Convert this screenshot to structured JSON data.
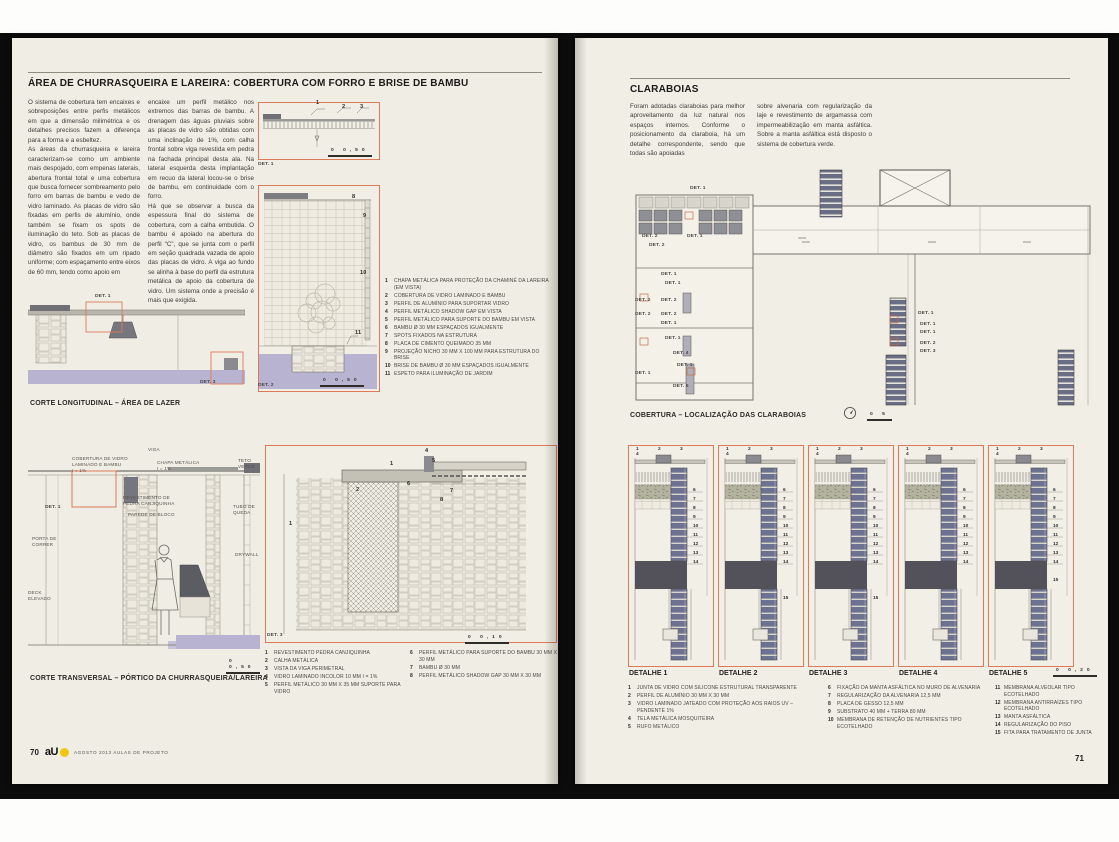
{
  "colors": {
    "accent_orange": "#dd7a58",
    "lavender": "#b7b3d1",
    "block_navy": "#6d7290",
    "slab_gray": "#53525b",
    "logo_yellow": "#f2c50f",
    "page_cream": "#f0ede4"
  },
  "left_page": {
    "title": "ÁREA DE CHURRASQUEIRA E LAREIRA: COBERTURA COM FORRO E BRISE DE BAMBU",
    "intro_col1": "O sistema de cobertura tem encaixes e sobreposições entre perfis metálicos em que a dimensão milimétrica e os detalhes precisos fazem a diferença para a forma e a esbeltez.\nAs áreas da churrasqueira e lareira caracterizam-se como um ambiente mais despojado, com empenas laterais, abertura frontal total e uma cobertura que busca fornecer sombreamento pelo forro em barras de bambu e vedo de vidro laminado. As placas de vidro são fixadas em perfis de alumínio, onde também se fixam os spots de iluminação do teto. Sob as placas de vidro, os bambus de 30 mm de diâmetro são fixados em um ripado uniforme; com espaçamento entre eixos de 60 mm, tendo como apoio em",
    "intro_col2": "encaixe um perfil metálico nos extremos das barras de bambu. A drenagem das águas pluviais sobre as placas de vidro são obtidas com uma inclinação de 1%, com calha frontal sobre viga revestida em pedra na fachada principal desta ala. Na lateral esquerda desta implantação em recuo da lateral locou-se o brise de bambu, em continuidade com o forro.\nHá que se observar a busca da espessura final do sistema de cobertura, com a calha embutida. O bambu é apoiado na abertura do perfil “C”, que se junta com o perfil em seção quadrada vazada de apoio das placas de vidro. A viga ao fundo se alinha à base do perfil da estrutura metálica de apoio da cobertura de vidro. Um sistema onde a precisão é mais que exigida.",
    "caption_longitudinal": "CORTE LONGITUDINAL – ÁREA DE LAZER",
    "caption_transversal": "CORTE TRANSVERSAL – PÓRTICO DA CHURRASQUEIRA/LAREIRA",
    "legend_top": [
      {
        "n": "1",
        "text": "CHAPA METÁLICA PARA PROTEÇÃO DA CHAMINÉ DA LAREIRA (EM VISTA)"
      },
      {
        "n": "2",
        "text": "COBERTURA DE VIDRO LAMINADO E BAMBU"
      },
      {
        "n": "3",
        "text": "PERFIL DE ALUMÍNIO PARA SUPORTAR VIDRO"
      },
      {
        "n": "4",
        "text": "PERFIL METÁLICO SHADOW GAP EM VISTA"
      },
      {
        "n": "5",
        "text": "PERFIL METÁLICO PARA SUPORTE DO BAMBU EM VISTA"
      },
      {
        "n": "6",
        "text": "BAMBU Ø 30 MM ESPAÇADOS IGUALMENTE"
      },
      {
        "n": "7",
        "text": "SPOTS FIXADOS NA ESTRUTURA"
      },
      {
        "n": "8",
        "text": "PLACA DE CIMENTO QUEIMADO 35 MM"
      },
      {
        "n": "9",
        "text": "PROJEÇÃO NICHO 30 MM X 100 MM PARA ESTRUTURA DO BRISE"
      },
      {
        "n": "10",
        "text": "BRISE DE BAMBU Ø 30 MM ESPAÇADOS IGUALMENTE"
      },
      {
        "n": "11",
        "text": "ESPETO PARA ILUMINAÇÃO DE JARDIM"
      }
    ],
    "legend_bottom_a": [
      {
        "n": "1",
        "text": "REVESTIMENTO PEDRA CANJIQUINHA"
      },
      {
        "n": "2",
        "text": "CALHA METÁLICA"
      },
      {
        "n": "3",
        "text": "VISTA DA VIGA PERIMETRAL"
      },
      {
        "n": "4",
        "text": "VIDRO LAMINADO INCOLOR 10 MM I = 1%"
      },
      {
        "n": "5",
        "text": "PERFIL METÁLICO 30 MM X 35 MM SUPORTE PARA VIDRO"
      }
    ],
    "legend_bottom_b": [
      {
        "n": "6",
        "text": "PERFIL METÁLICO PARA SUPORTE DO BAMBU 30 MM X 30 MM"
      },
      {
        "n": "7",
        "text": "BAMBU Ø 30 MM"
      },
      {
        "n": "8",
        "text": "PERFIL METÁLICO SHADOW GAP 30 MM X 30 MM"
      }
    ],
    "det1_anns": [
      {
        "text": "1",
        "x": 58,
        "y": -2,
        "cls": "callout"
      },
      {
        "text": "2",
        "x": 84,
        "y": 2,
        "cls": "callout"
      },
      {
        "text": "3",
        "x": 102,
        "y": 2,
        "cls": "callout"
      },
      {
        "text": "DET. 1",
        "x": 0,
        "y": 60,
        "cls": "det"
      },
      {
        "text": "0  0,50",
        "x": 70,
        "y": 46,
        "cls": "scale"
      }
    ],
    "det2_anns": [
      {
        "text": "8",
        "x": 94,
        "y": 9,
        "cls": "callout"
      },
      {
        "text": "9",
        "x": 105,
        "y": 28,
        "cls": "callout"
      },
      {
        "text": "10",
        "x": 102,
        "y": 85,
        "cls": "callout"
      },
      {
        "text": "11",
        "x": 97,
        "y": 145,
        "cls": "callout"
      },
      {
        "text": "DET. 2",
        "x": 0,
        "y": 198,
        "cls": "det"
      },
      {
        "text": "0  0,50",
        "x": 62,
        "y": 193,
        "cls": "scale"
      }
    ],
    "long_anns": [
      {
        "text": "DET. 1",
        "x": 67,
        "y": -6,
        "cls": "det"
      },
      {
        "text": "DET. 3",
        "x": 172,
        "y": 80,
        "cls": "det"
      }
    ],
    "trans_anns": [
      {
        "text": "VIGA",
        "x": 120,
        "y": 2
      },
      {
        "text": "COBERTURA DE VIDRO\nLAMINADO E BAMBU\nI = 1%",
        "x": 44,
        "y": 11
      },
      {
        "text": "CHAPA METÁLICA\nI = 1%",
        "x": 129,
        "y": 15
      },
      {
        "text": "TETO\nVERDE",
        "x": 210,
        "y": 13
      },
      {
        "text": "REVESTIMENTO DE\nPEDRA CANJIQUINHA",
        "x": 95,
        "y": 50
      },
      {
        "text": "PAREDE DE BLOCO",
        "x": 100,
        "y": 67
      },
      {
        "text": "TUBO DE\nQUEDA",
        "x": 205,
        "y": 59
      },
      {
        "text": "DRYWALL",
        "x": 207,
        "y": 107
      },
      {
        "text": "PORTA DE\nCORRER",
        "x": 4,
        "y": 91
      },
      {
        "text": "DECK\nELEVADO",
        "x": 0,
        "y": 145
      },
      {
        "text": "DET. 1",
        "x": 17,
        "y": 60,
        "cls": "det"
      },
      {
        "text": "0  0,50",
        "x": 198,
        "y": 214,
        "cls": "scale"
      }
    ],
    "det3_anns": [
      {
        "text": "1",
        "x": 125,
        "y": 16,
        "cls": "callout"
      },
      {
        "text": "2",
        "x": 91,
        "y": 42,
        "cls": "callout"
      },
      {
        "text": "4",
        "x": 160,
        "y": 3,
        "cls": "callout"
      },
      {
        "text": "5",
        "x": 167,
        "y": 13,
        "cls": "callout"
      },
      {
        "text": "6",
        "x": 142,
        "y": 36,
        "cls": "callout"
      },
      {
        "text": "7",
        "x": 185,
        "y": 43,
        "cls": "callout"
      },
      {
        "text": "8",
        "x": 175,
        "y": 52,
        "cls": "callout"
      },
      {
        "text": "1",
        "x": 24,
        "y": 76,
        "cls": "callout"
      },
      {
        "text": "DET. 3",
        "x": 2,
        "y": 188,
        "cls": "det"
      },
      {
        "text": "0  0,10",
        "x": 200,
        "y": 190,
        "cls": "scale"
      }
    ],
    "footer": {
      "page_number": "70",
      "brand": "aU",
      "text": "AGOSTO 2013 AULAS DE PROJETO"
    }
  },
  "right_page": {
    "title": "CLARABOIAS",
    "intro_col1": "Foram adotadas claraboias para melhor aproveitamento da luz natural nos espaços internos. Conforme o posicionamento da claraboia, há um detalhe correspondente, sendo que todas são apoiadas",
    "intro_col2": "sobre alvenaria com regularização da laje e revestimento de argamassa com impermeabilização em manta asfáltica. Sobre a manta asfáltica está disposto o sistema de cobertura verde.",
    "caption_plan": "COBERTURA – LOCALIZAÇÃO DAS CLARABOIAS",
    "plan_scale": "0       5",
    "plan_labels": [
      {
        "text": "DET. 1",
        "x": 62,
        "y": 18,
        "cls": "det"
      },
      {
        "text": "DET. 2",
        "x": 14,
        "y": 66,
        "cls": "det"
      },
      {
        "text": "DET. 1",
        "x": 59,
        "y": 66,
        "cls": "det"
      },
      {
        "text": "DET. 2",
        "x": 21,
        "y": 75,
        "cls": "det"
      },
      {
        "text": "DET. 1",
        "x": 33,
        "y": 104,
        "cls": "det"
      },
      {
        "text": "DET. 1",
        "x": 37,
        "y": 113,
        "cls": "det"
      },
      {
        "text": "DET. 2",
        "x": 7,
        "y": 130,
        "cls": "det"
      },
      {
        "text": "DET. 2",
        "x": 33,
        "y": 130,
        "cls": "det"
      },
      {
        "text": "DET. 2",
        "x": 7,
        "y": 144,
        "cls": "det"
      },
      {
        "text": "DET. 2",
        "x": 33,
        "y": 144,
        "cls": "det"
      },
      {
        "text": "DET. 1",
        "x": 33,
        "y": 153,
        "cls": "det"
      },
      {
        "text": "DET. 1",
        "x": 37,
        "y": 168,
        "cls": "det"
      },
      {
        "text": "DET. 4",
        "x": 45,
        "y": 183,
        "cls": "det"
      },
      {
        "text": "DET. 1",
        "x": 49,
        "y": 195,
        "cls": "det"
      },
      {
        "text": "DET. 1",
        "x": 7,
        "y": 203,
        "cls": "det"
      },
      {
        "text": "DET. 5",
        "x": 45,
        "y": 216,
        "cls": "det"
      },
      {
        "text": "DET. 1",
        "x": 290,
        "y": 143,
        "cls": "det"
      },
      {
        "text": "DET. 1",
        "x": 292,
        "y": 154,
        "cls": "det"
      },
      {
        "text": "DET. 1",
        "x": 292,
        "y": 162,
        "cls": "det"
      },
      {
        "text": "DET. 2",
        "x": 292,
        "y": 173,
        "cls": "det"
      },
      {
        "text": "DET. 3",
        "x": 292,
        "y": 181,
        "cls": "det"
      }
    ],
    "details": [
      {
        "label": "DETALHE 1",
        "cls": "short",
        "top": "1 2 3 4",
        "side": "6\n7\n8\n9\n10\n11\n12\n13\n14"
      },
      {
        "label": "DETALHE 2",
        "cls": "long",
        "top": "1 2 3 4",
        "side": "6\n7\n8\n9\n10\n11\n12\n13\n14\n\n\n\n15"
      },
      {
        "label": "DETALHE 3",
        "cls": "long",
        "top": "1 2 3 4",
        "side": "6\n7\n8\n9\n10\n11\n12\n13\n14\n\n\n\n15"
      },
      {
        "label": "DETALHE 4",
        "cls": "short",
        "top": "1 2 3 4",
        "side": "6\n7\n8\n9\n10\n11\n12\n13\n14"
      },
      {
        "label": "DETALHE 5",
        "cls": "long",
        "top": "1 2 3 4",
        "side": "6\n7\n8\n9\n10\n11\n12\n13\n14\n\n15"
      }
    ],
    "detail_scale": "0  0,20",
    "legend_col1": [
      {
        "n": "1",
        "text": "JUNTA DE VIDRO COM SILICONE ESTRUTURAL TRANSPARENTE"
      },
      {
        "n": "2",
        "text": "PERFIL DE ALUMÍNIO 30 MM X 30 MM"
      },
      {
        "n": "3",
        "text": "VIDRO LAMINADO JATEADO COM PROTEÇÃO AOS RAIOS UV – PENDENTE 1%"
      },
      {
        "n": "4",
        "text": "TELA METÁLICA MOSQUITEIRA"
      },
      {
        "n": "5",
        "text": "RUFO METÁLICO"
      }
    ],
    "legend_col2": [
      {
        "n": "6",
        "text": "FIXAÇÃO DA MANTA ASFÁLTICA NO MURO DE ALVENARIA"
      },
      {
        "n": "7",
        "text": "REGULARIZAÇÃO DA ALVENARIA 12,5 MM"
      },
      {
        "n": "8",
        "text": "PLACA DE GESSO 12,5 MM"
      },
      {
        "n": "9",
        "text": "SUBSTRATO 40 MM + TERRA 80 MM"
      },
      {
        "n": "10",
        "text": "MEMBRANA DE RETENÇÃO DE NUTRIENTES TIPO ECOTELHADO"
      }
    ],
    "legend_col3": [
      {
        "n": "11",
        "text": "MEMBRANA ALVEOLAR TIPO ECOTELHADO"
      },
      {
        "n": "12",
        "text": "MEMBRANA ANTIRRAÍZES TIPO ECOTELHADO"
      },
      {
        "n": "13",
        "text": "MANTA ASFÁLTICA"
      },
      {
        "n": "14",
        "text": "REGULARIZAÇÃO DO PISO"
      },
      {
        "n": "15",
        "text": "FITA PARA TRATAMENTO DE JUNTA"
      }
    ],
    "footer": {
      "page_number": "71"
    }
  }
}
